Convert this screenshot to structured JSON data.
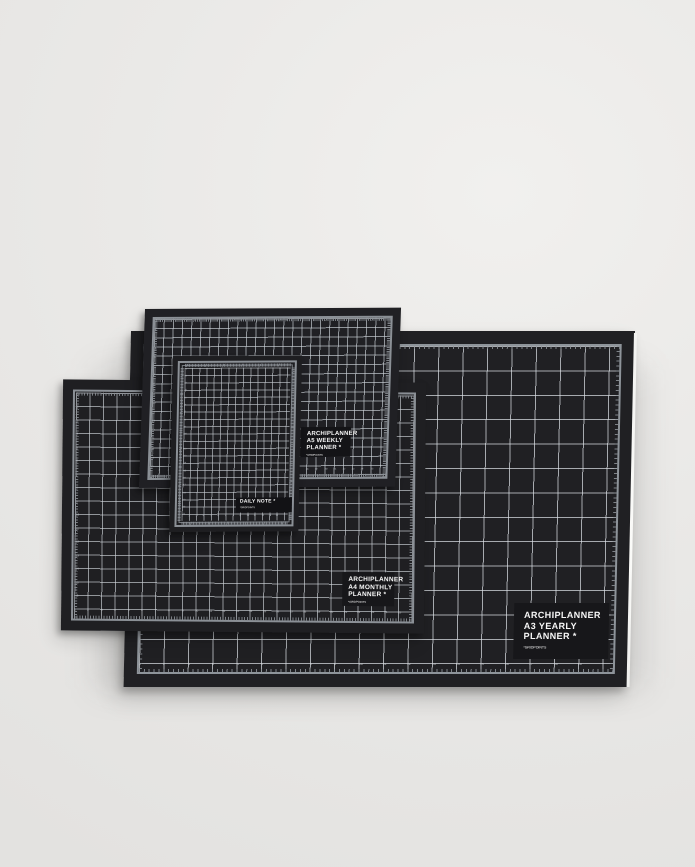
{
  "scene": {
    "background_color": "#e9e8e6",
    "shadow_color": "rgba(0,0,0,0.25)"
  },
  "mats": [
    {
      "id": "a3-yearly",
      "brand": "ARCHIPLANNER",
      "size_line": "A3 YEARLY",
      "product_line": "PLANNER *",
      "footnote": "*GRIDPOINTS",
      "surface_color": "#202023",
      "grid_line_color": "rgba(219,224,229,0.72)",
      "frame_color": "#8e949a",
      "number_color": "#c7cbd0",
      "label_bg": "#17171a",
      "label_text_color": "#f7f7f7",
      "rulers": {
        "bottom": {
          "from": 1,
          "to": 19
        }
      }
    },
    {
      "id": "a4-monthly",
      "brand": "ARCHIPLANNER",
      "size_line": "A4 MONTHLY",
      "product_line": "PLANNER *",
      "footnote": "*GRIDPOINTS",
      "surface_color": "#1f1f22",
      "grid_line_color": "rgba(206,211,217,0.66)",
      "frame_color": "#8b9096",
      "number_color": "#c3c7cc",
      "label_bg": "#17171a",
      "label_text_color": "#f7f7f7",
      "rulers": {
        "bottom": {
          "from": 1,
          "to": 25
        },
        "left": {
          "from": 1,
          "to": 16
        }
      }
    },
    {
      "id": "a5-weekly",
      "brand": "ARCHIPLANNER",
      "size_line": "A5 WEEKLY",
      "product_line": "PLANNER *",
      "footnote": "*GRIDPOINTS",
      "surface_color": "#202024",
      "grid_line_color": "rgba(199,205,211,0.68)",
      "frame_color": "#8b9096",
      "number_color": "#c3c7cc",
      "label_bg": "#141417",
      "label_text_color": "#f7f7f7",
      "rulers": {
        "bottom": {
          "from": 1,
          "to": 25
        },
        "left": {
          "from": 1,
          "to": 17
        }
      }
    },
    {
      "id": "daily-note",
      "title": "DAILY NOTE *",
      "footnote": "*GRIDPOINTS",
      "surface_color": "#1e1e21",
      "grid_line_color": "rgba(196,201,207,0.64)",
      "frame_color": "#8b9096",
      "number_color": "#bfc3c8",
      "label_bg": "#121215",
      "label_text_color": "#f7f7f7",
      "rulers": {
        "bottom": {
          "from": 1,
          "to": 14
        },
        "left": {
          "from": 1,
          "to": 21
        }
      }
    }
  ]
}
